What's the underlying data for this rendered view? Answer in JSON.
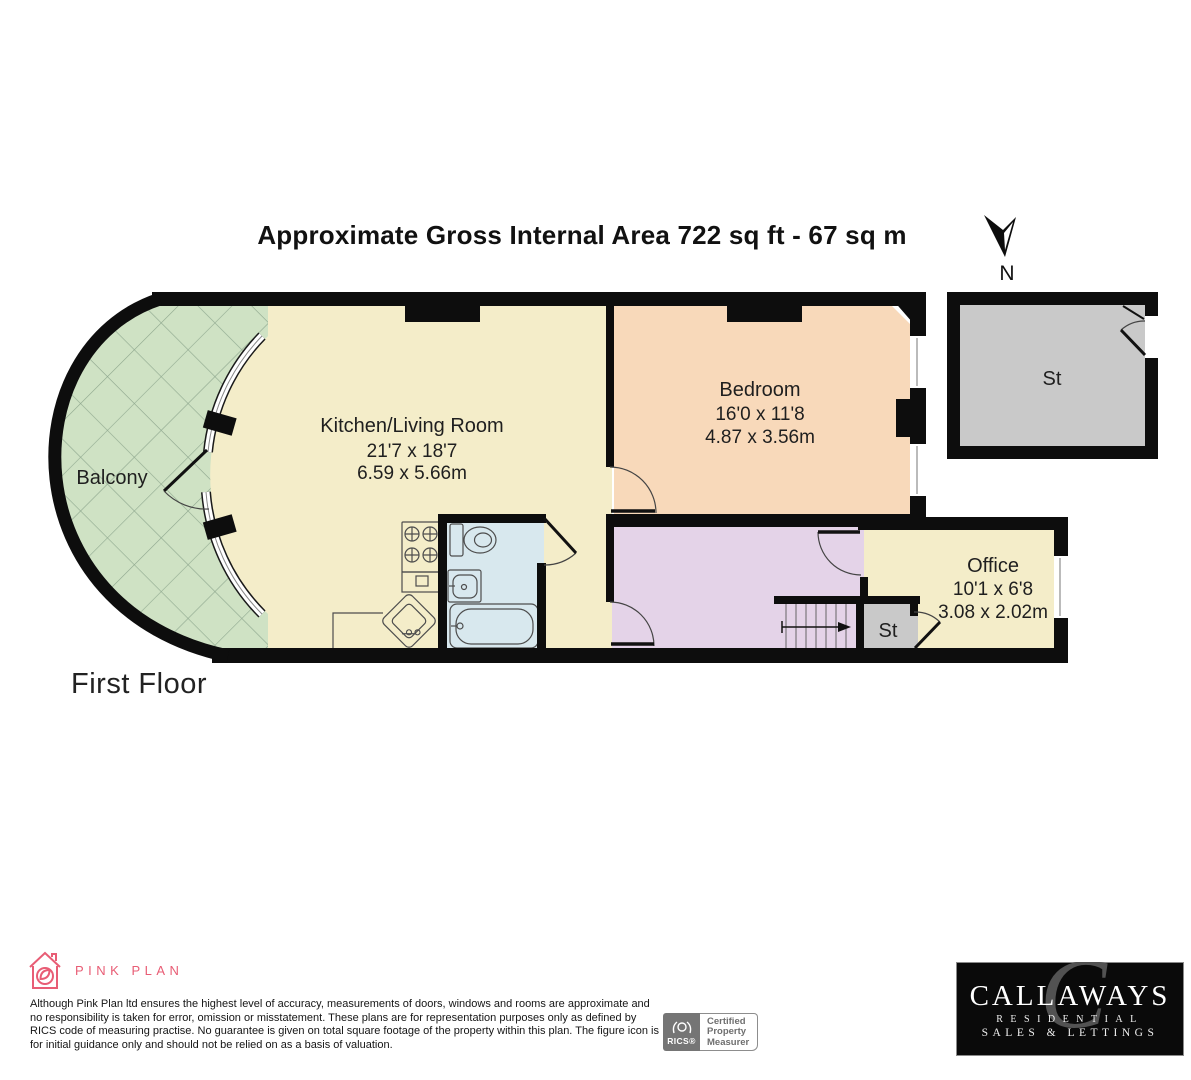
{
  "title": "Approximate Gross Internal Area 722 sq ft - 67 sq m",
  "compass": {
    "label": "N"
  },
  "floor_label": "First Floor",
  "rooms": {
    "balcony": {
      "name": "Balcony"
    },
    "kitchen_living": {
      "name": "Kitchen/Living Room",
      "dims_imperial": "21'7 x 18'7",
      "dims_metric": "6.59 x 5.66m"
    },
    "bedroom": {
      "name": "Bedroom",
      "dims_imperial": "16'0 x 11'8",
      "dims_metric": "4.87 x 3.56m"
    },
    "office": {
      "name": "Office",
      "dims_imperial": "10'1 x 6'8",
      "dims_metric": "3.08 x 2.02m"
    },
    "storage_large": {
      "name": "St"
    },
    "storage_small": {
      "name": "St"
    }
  },
  "footer": {
    "brand": "PINK PLAN",
    "disclaimer": "Although Pink Plan ltd ensures the highest level of accuracy, measurements of doors, windows and rooms are approximate and no responsibility is taken for error, omission or misstatement. These plans are for representation purposes only as defined by RICS code of measuring practise. No guarantee is given on total square footage of the property within this plan. The figure icon is for initial guidance only and should not be relied on as a basis of valuation.",
    "rics_badge": {
      "org": "RICS®",
      "line1": "Certified",
      "line2": "Property",
      "line3": "Measurer"
    },
    "agency": {
      "name": "CALLAWAYS",
      "tagline1": "RESIDENTIAL",
      "tagline2": "SALES & LETTINGS"
    }
  },
  "colors": {
    "wall": "#0d0d0d",
    "kitchen": "#f4edc9",
    "bedroom": "#f8d9ba",
    "hallway": "#e4d3e8",
    "bathroom": "#d8e8ee",
    "balcony": "#cfe2c4",
    "storage": "#c9c9c9",
    "brand_pink": "#e85d75"
  }
}
